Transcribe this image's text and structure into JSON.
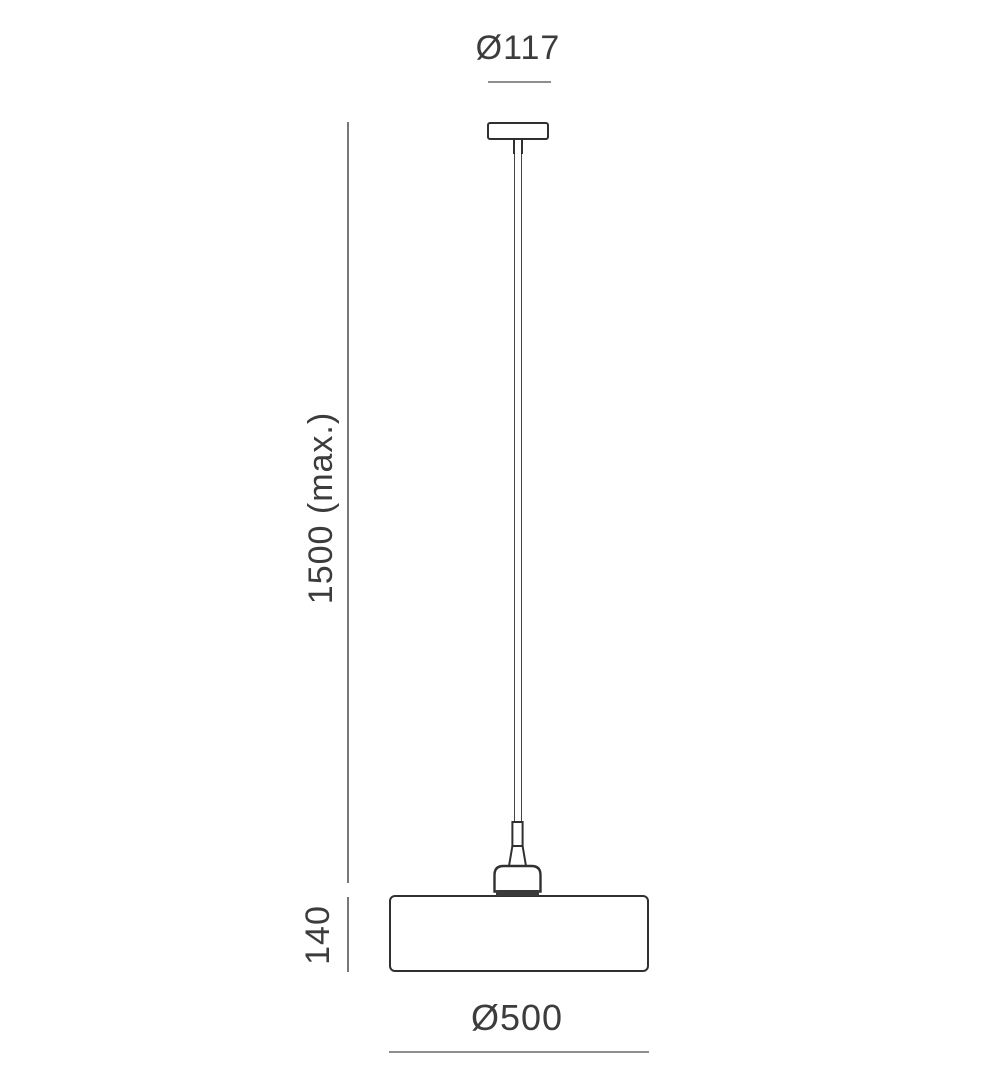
{
  "drawing": {
    "type": "technical-dimension-drawing",
    "subject": "pendant-lamp",
    "labels": {
      "canopy_diameter": "Ø117",
      "suspension_length": "1500 (max.)",
      "shade_height": "140",
      "shade_diameter": "Ø500"
    },
    "colors": {
      "outline": "#303030",
      "cord_line": "#454545",
      "dimension_line_horizontal": "#8e8e8e",
      "dimension_line_vertical": "#787878",
      "socket_base_fill": "#3a3a3a",
      "label_text": "#3c3c3c",
      "background": "#ffffff"
    }
  }
}
